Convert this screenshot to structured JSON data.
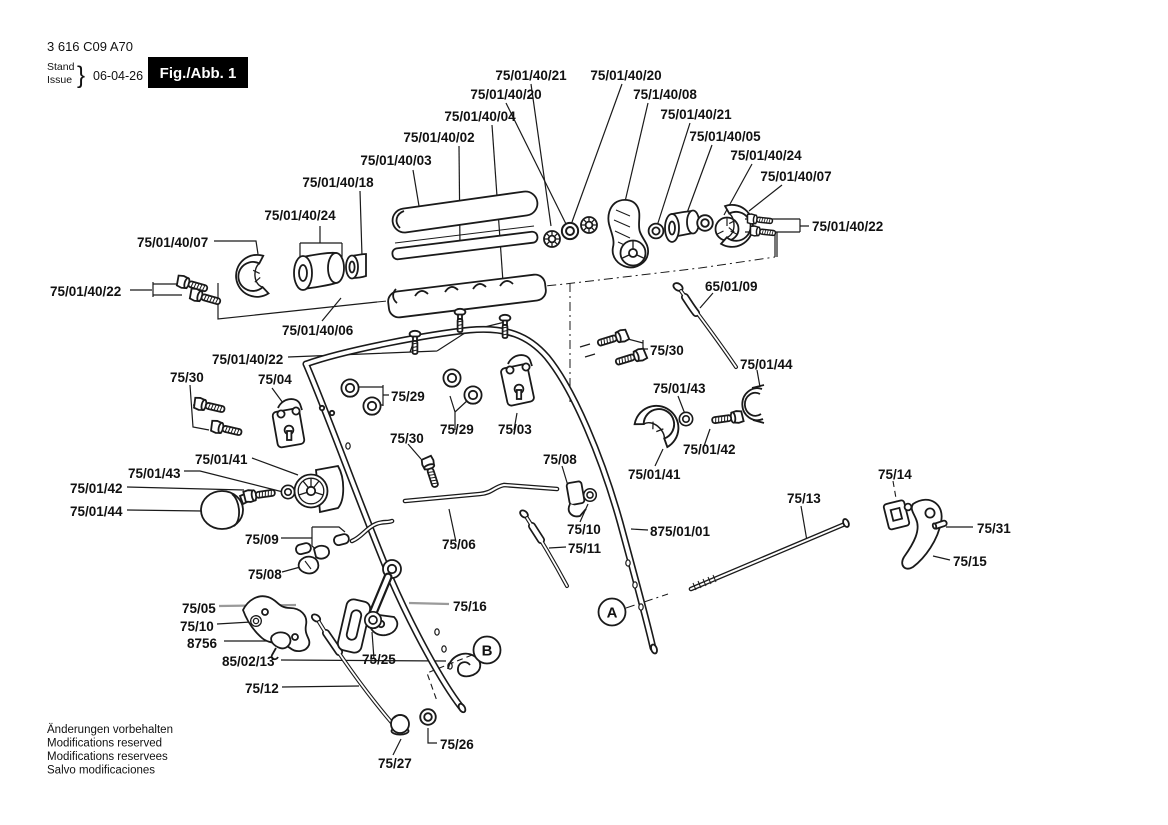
{
  "title_block": {
    "part_number": "3 616 C09 A70",
    "stand_label": "Stand",
    "issue_label": "Issue",
    "brace": "}",
    "date": "06-04-26",
    "figure_label": "Fig./Abb. 1"
  },
  "callouts": {
    "a": "A",
    "b": "B"
  },
  "footer_notes": [
    "Änderungen vorbehalten",
    "Modifications reserved",
    "Modifications reservees",
    "Salvo modificaciones"
  ],
  "part_labels": [
    {
      "text": "75/01/40/21",
      "x": 531,
      "y": 80,
      "a": "m"
    },
    {
      "text": "75/01/40/20",
      "x": 626,
      "y": 80,
      "a": "m"
    },
    {
      "text": "75/01/40/20",
      "x": 506,
      "y": 99,
      "a": "m"
    },
    {
      "text": "75/1/40/08",
      "x": 665,
      "y": 99,
      "a": "m"
    },
    {
      "text": "75/01/40/04",
      "x": 480,
      "y": 121,
      "a": "m"
    },
    {
      "text": "75/01/40/21",
      "x": 696,
      "y": 119,
      "a": "m"
    },
    {
      "text": "75/01/40/02",
      "x": 439,
      "y": 142,
      "a": "m"
    },
    {
      "text": "75/01/40/05",
      "x": 725,
      "y": 141,
      "a": "m"
    },
    {
      "text": "75/01/40/03",
      "x": 396,
      "y": 165,
      "a": "m"
    },
    {
      "text": "75/01/40/24",
      "x": 766,
      "y": 160,
      "a": "m"
    },
    {
      "text": "75/01/40/18",
      "x": 338,
      "y": 187,
      "a": "m"
    },
    {
      "text": "75/01/40/07",
      "x": 796,
      "y": 181,
      "a": "m"
    },
    {
      "text": "75/01/40/24",
      "x": 300,
      "y": 220,
      "a": "m"
    },
    {
      "text": "75/01/40/22",
      "x": 812,
      "y": 231,
      "a": "s"
    },
    {
      "text": "75/01/40/07",
      "x": 137,
      "y": 247,
      "a": "s"
    },
    {
      "text": "75/01/40/22",
      "x": 50,
      "y": 296,
      "a": "s"
    },
    {
      "text": "65/01/09",
      "x": 705,
      "y": 291,
      "a": "s"
    },
    {
      "text": "75/01/40/06",
      "x": 282,
      "y": 335,
      "a": "s"
    },
    {
      "text": "75/01/40/22",
      "x": 212,
      "y": 364,
      "a": "s"
    },
    {
      "text": "75/30",
      "x": 650,
      "y": 355,
      "a": "s"
    },
    {
      "text": "75/01/44",
      "x": 740,
      "y": 369,
      "a": "s"
    },
    {
      "text": "75/30",
      "x": 170,
      "y": 382,
      "a": "s"
    },
    {
      "text": "75/04",
      "x": 258,
      "y": 384,
      "a": "s"
    },
    {
      "text": "75/29",
      "x": 391,
      "y": 401,
      "a": "s"
    },
    {
      "text": "75/01/43",
      "x": 653,
      "y": 393,
      "a": "s"
    },
    {
      "text": "75/29",
      "x": 440,
      "y": 434,
      "a": "s"
    },
    {
      "text": "75/03",
      "x": 498,
      "y": 434,
      "a": "s"
    },
    {
      "text": "75/30",
      "x": 390,
      "y": 443,
      "a": "s"
    },
    {
      "text": "75/01/42",
      "x": 683,
      "y": 454,
      "a": "s"
    },
    {
      "text": "75/08",
      "x": 543,
      "y": 464,
      "a": "s"
    },
    {
      "text": "75/01/41",
      "x": 628,
      "y": 479,
      "a": "s"
    },
    {
      "text": "75/14",
      "x": 878,
      "y": 479,
      "a": "s"
    },
    {
      "text": "75/01/43",
      "x": 128,
      "y": 478,
      "a": "s"
    },
    {
      "text": "75/01/41",
      "x": 195,
      "y": 464,
      "a": "s"
    },
    {
      "text": "75/01/42",
      "x": 70,
      "y": 493,
      "a": "s"
    },
    {
      "text": "75/13",
      "x": 787,
      "y": 503,
      "a": "s"
    },
    {
      "text": "75/01/44",
      "x": 70,
      "y": 516,
      "a": "s"
    },
    {
      "text": "875/01/01",
      "x": 650,
      "y": 536,
      "a": "s"
    },
    {
      "text": "75/31",
      "x": 977,
      "y": 533,
      "a": "s"
    },
    {
      "text": "75/09",
      "x": 245,
      "y": 544,
      "a": "s"
    },
    {
      "text": "75/06",
      "x": 442,
      "y": 549,
      "a": "s"
    },
    {
      "text": "75/10",
      "x": 567,
      "y": 534,
      "a": "s"
    },
    {
      "text": "75/11",
      "x": 568,
      "y": 553,
      "a": "s"
    },
    {
      "text": "75/15",
      "x": 953,
      "y": 566,
      "a": "s"
    },
    {
      "text": "75/08",
      "x": 248,
      "y": 579,
      "a": "s"
    },
    {
      "text": "75/05",
      "x": 182,
      "y": 613,
      "a": "s"
    },
    {
      "text": "75/16",
      "x": 453,
      "y": 611,
      "a": "s"
    },
    {
      "text": "75/10",
      "x": 180,
      "y": 631,
      "a": "s"
    },
    {
      "text": "8756",
      "x": 187,
      "y": 648,
      "a": "s"
    },
    {
      "text": "85/02/13",
      "x": 222,
      "y": 666,
      "a": "s"
    },
    {
      "text": "75/25",
      "x": 362,
      "y": 664,
      "a": "s"
    },
    {
      "text": "75/12",
      "x": 245,
      "y": 693,
      "a": "s"
    },
    {
      "text": "75/26",
      "x": 440,
      "y": 749,
      "a": "s"
    },
    {
      "text": "75/27",
      "x": 378,
      "y": 768,
      "a": "s"
    }
  ]
}
